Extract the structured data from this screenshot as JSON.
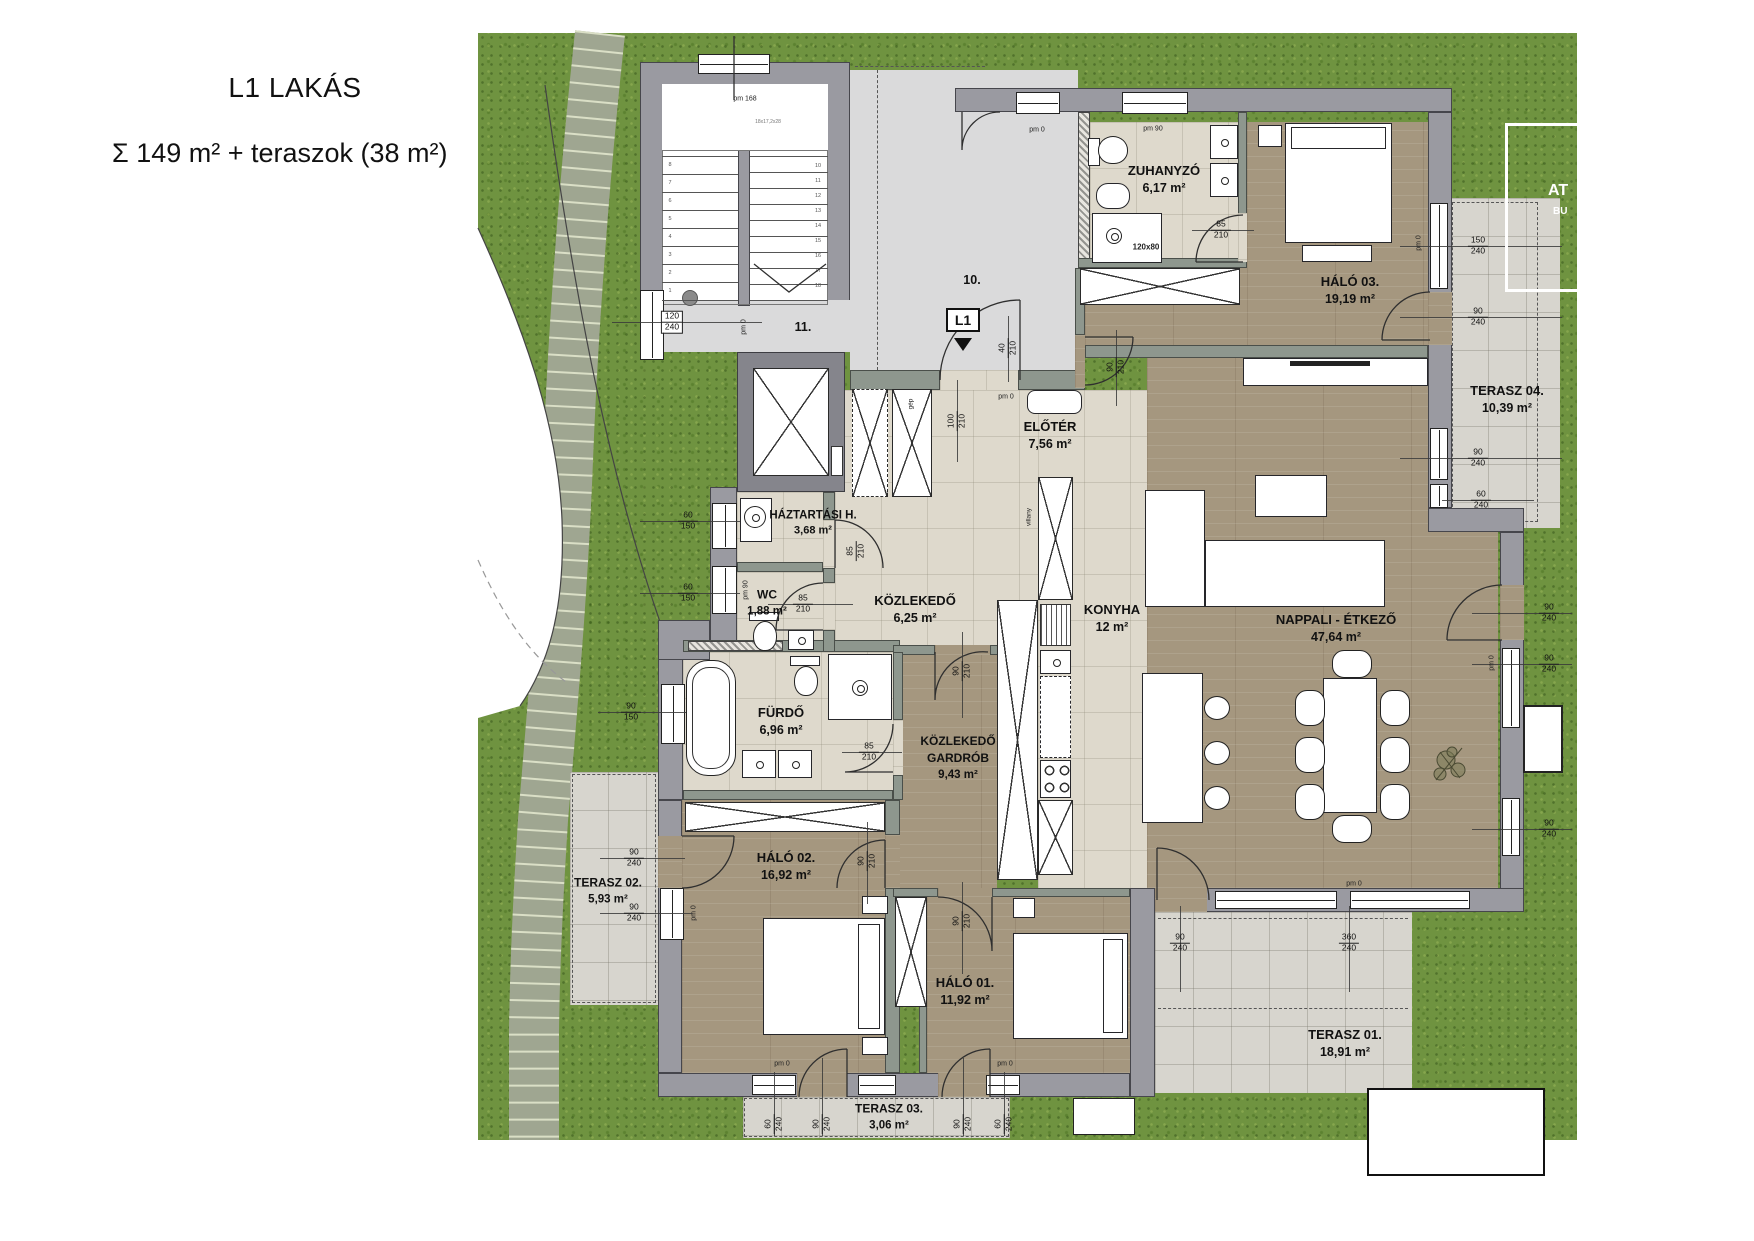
{
  "header": {
    "title": "L1 LAKÁS",
    "subtitle": "Σ 149 m² + teraszok (38 m²)"
  },
  "rooms": {
    "zuhanyzo": {
      "name": "ZUHANYZÓ",
      "area": "6,17 m²"
    },
    "halo03": {
      "name": "HÁLÓ 03.",
      "area": "19,19 m²"
    },
    "terasz04": {
      "name": "TERASZ 04.",
      "area": "10,39 m²"
    },
    "eloter": {
      "name": "ELŐTÉR",
      "area": "7,56 m²"
    },
    "haztartasi": {
      "name": "HÁZTARTÁSI H.",
      "area": "3,68 m²"
    },
    "wc": {
      "name": "WC",
      "area": "1,88 m²"
    },
    "kozlekedo": {
      "name": "KÖZLEKEDŐ",
      "area": "6,25 m²"
    },
    "konyha": {
      "name": "KONYHA",
      "area": "12 m²"
    },
    "nappali": {
      "name": "NAPPALI - ÉTKEZŐ",
      "area": "47,64 m²"
    },
    "furdo": {
      "name": "FÜRDŐ",
      "area": "6,96 m²"
    },
    "gardrob": {
      "name": "KÖZLEKEDŐ",
      "name2": "GARDRÓB",
      "area": "9,43 m²"
    },
    "halo02": {
      "name": "HÁLÓ 02.",
      "area": "16,92 m²"
    },
    "terasz02": {
      "name": "TERASZ 02.",
      "area": "5,93 m²"
    },
    "halo01": {
      "name": "HÁLÓ 01.",
      "area": "11,92 m²"
    },
    "terasz03": {
      "name": "TERASZ 03.",
      "area": "3,06 m²"
    },
    "terasz01": {
      "name": "TERASZ 01.",
      "area": "18,91 m²"
    }
  },
  "markers": {
    "unit_badge": "L1",
    "hall_upper": "10.",
    "hall_lower": "11.",
    "shower_size": "120x80",
    "machine": "gép",
    "electric": "villany",
    "stair_note": "18x17,2x28"
  },
  "watermark": {
    "line1": "AT",
    "line2": "BU"
  },
  "pms": [
    "pm 168",
    "pm 0",
    "pm 90",
    "pm 0",
    "pm 0",
    "pm 90",
    "pm 0",
    "pm 0",
    "pm 0",
    "pm 0",
    "pm 0",
    "pm 0"
  ],
  "dims": [
    {
      "a": "120",
      "b": "240"
    },
    {
      "a": "60",
      "b": "150"
    },
    {
      "a": "60",
      "b": "150"
    },
    {
      "a": "90",
      "b": "150"
    },
    {
      "a": "90",
      "b": "240"
    },
    {
      "a": "90",
      "b": "240"
    },
    {
      "a": "90",
      "b": "210"
    },
    {
      "a": "90",
      "b": "210"
    },
    {
      "a": "90",
      "b": "210"
    },
    {
      "a": "85",
      "b": "210"
    },
    {
      "a": "85",
      "b": "210"
    },
    {
      "a": "85",
      "b": "210"
    },
    {
      "a": "85",
      "b": "210"
    },
    {
      "a": "100",
      "b": "210"
    },
    {
      "a": "40",
      "b": "210"
    },
    {
      "a": "90",
      "b": "210"
    },
    {
      "a": "150",
      "b": "240"
    },
    {
      "a": "90",
      "b": "240"
    },
    {
      "a": "90",
      "b": "240"
    },
    {
      "a": "60",
      "b": "240"
    },
    {
      "a": "90",
      "b": "240"
    },
    {
      "a": "90",
      "b": "240"
    },
    {
      "a": "90",
      "b": "240"
    },
    {
      "a": "90",
      "b": "240"
    },
    {
      "a": "360",
      "b": "240"
    },
    {
      "a": "60",
      "b": "240"
    },
    {
      "a": "90",
      "b": "240"
    },
    {
      "a": "90",
      "b": "240"
    },
    {
      "a": "60",
      "b": "240"
    }
  ],
  "stairs": {
    "left": [
      "1",
      "2",
      "3",
      "4",
      "5",
      "6",
      "7",
      "8"
    ],
    "right": [
      "10",
      "11",
      "12",
      "13",
      "14",
      "15",
      "16",
      "17",
      "18"
    ]
  },
  "colors": {
    "grass": "#6f9340",
    "wall": "#9a9aa1",
    "partition": "#8e978e",
    "wood": "#a5977f",
    "tile": "#ded9cc",
    "terrace": "#d7d5ce",
    "hall": "#dadadb"
  }
}
